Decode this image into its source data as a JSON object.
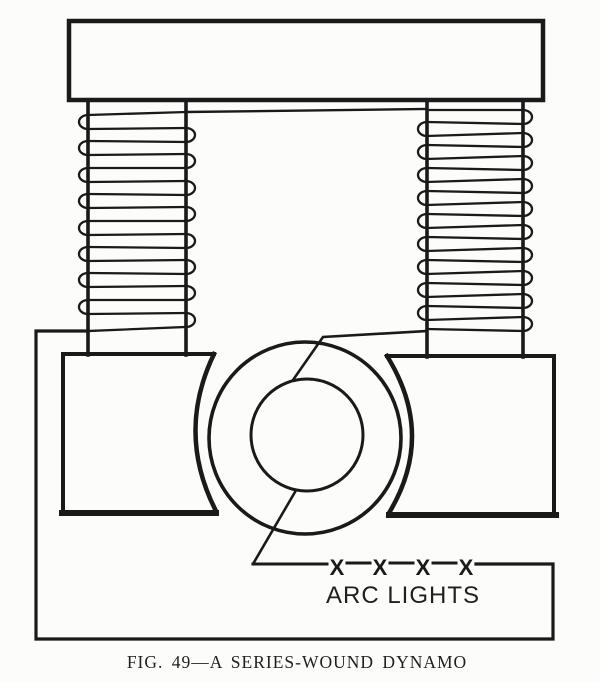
{
  "figure": {
    "caption": "FIG. 49—A SERIES-WOUND DYNAMO"
  },
  "labels": {
    "arc_lights": "ARC LIGHTS"
  },
  "arc_lamps": {
    "symbol": "X",
    "count": 4
  },
  "colors": {
    "ink": "#1a1a1a",
    "paper": "#fcfcfa"
  }
}
